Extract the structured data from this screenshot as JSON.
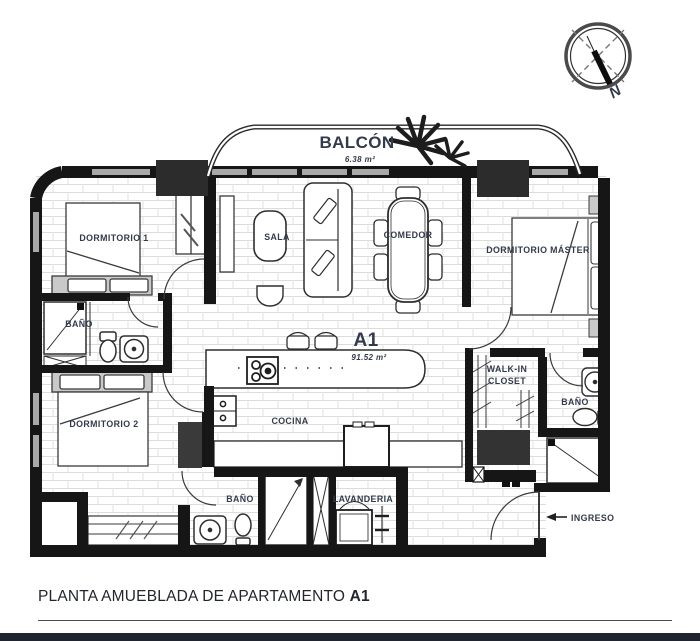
{
  "plan": {
    "balcony": {
      "label": "BALCÓN",
      "area": "6.38 m²"
    },
    "compass": {
      "label": "N"
    },
    "unit": {
      "label": "A1",
      "area": "91.52 m²"
    },
    "rooms": {
      "dormitorio1": "DORMITORIO 1",
      "sala": "SALA",
      "comedor": "COMEDOR",
      "dormitorioMaster": "DORMITORIO MÁSTER",
      "bano1": "BAÑO",
      "dormitorio2": "DORMITORIO 2",
      "walkinLine1": "WALK-IN",
      "walkinLine2": "CLOSET",
      "banoMaster": "BAÑO",
      "cocina": "COCINA",
      "bano2": "BAÑO",
      "lavanderia": "LAVANDERIA",
      "ingreso": "INGRESO"
    }
  },
  "caption": {
    "text": "PLANTA AMUEBLADA DE APARTAMENTO",
    "unit": "A1"
  },
  "colors": {
    "wall": "#161616",
    "window": "#a9a9a9",
    "brickLine": "#dcdcdc",
    "furnitureGray": "#c9c9c9",
    "darkBlock": "#363636",
    "labelText": "#333a4b",
    "bottomBar": "#20242e"
  }
}
